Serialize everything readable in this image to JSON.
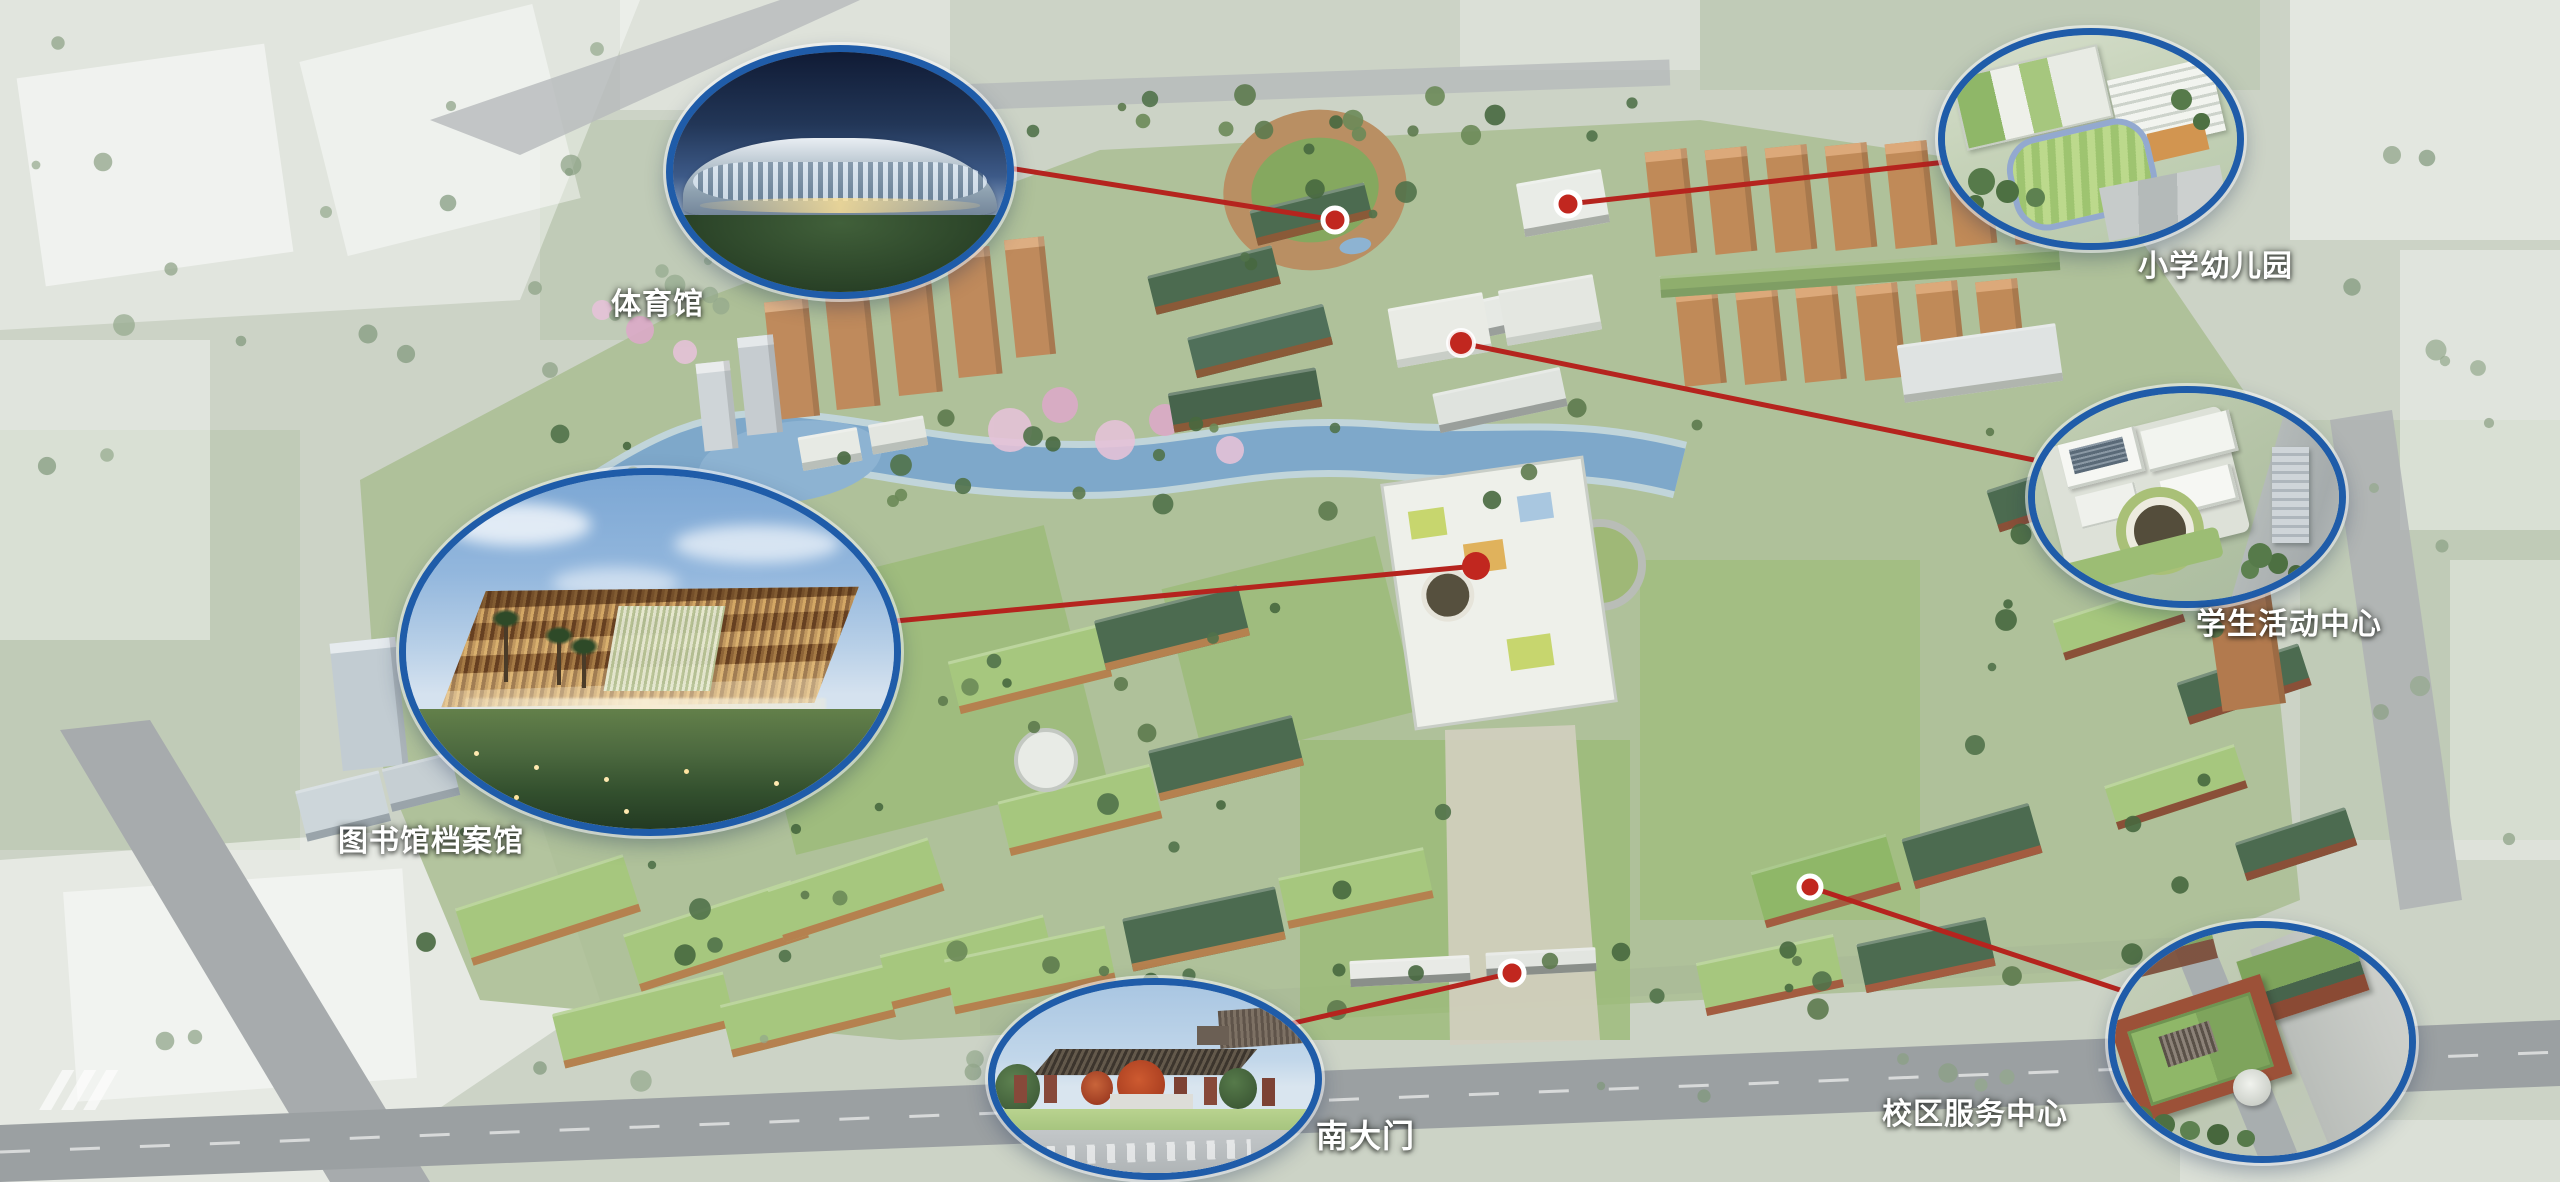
{
  "title": "校园整体鸟瞰效果图",
  "colors": {
    "callout_border": "#1f5ca9",
    "connector_line": "#b5241e",
    "marker_fill": "#c1271f",
    "marker_ring": "#ffffff",
    "label_text": "#ffffff"
  },
  "callouts": [
    {
      "id": "gymnasium",
      "label": "体育馆"
    },
    {
      "id": "primary-school-kindergarten",
      "label": "小学幼儿园"
    },
    {
      "id": "student-activity-center",
      "label": "学生活动中心"
    },
    {
      "id": "library-archives",
      "label": "图书馆档案馆"
    },
    {
      "id": "south-gate",
      "label": "南大门"
    },
    {
      "id": "campus-service-center",
      "label": "校区服务中心"
    }
  ]
}
